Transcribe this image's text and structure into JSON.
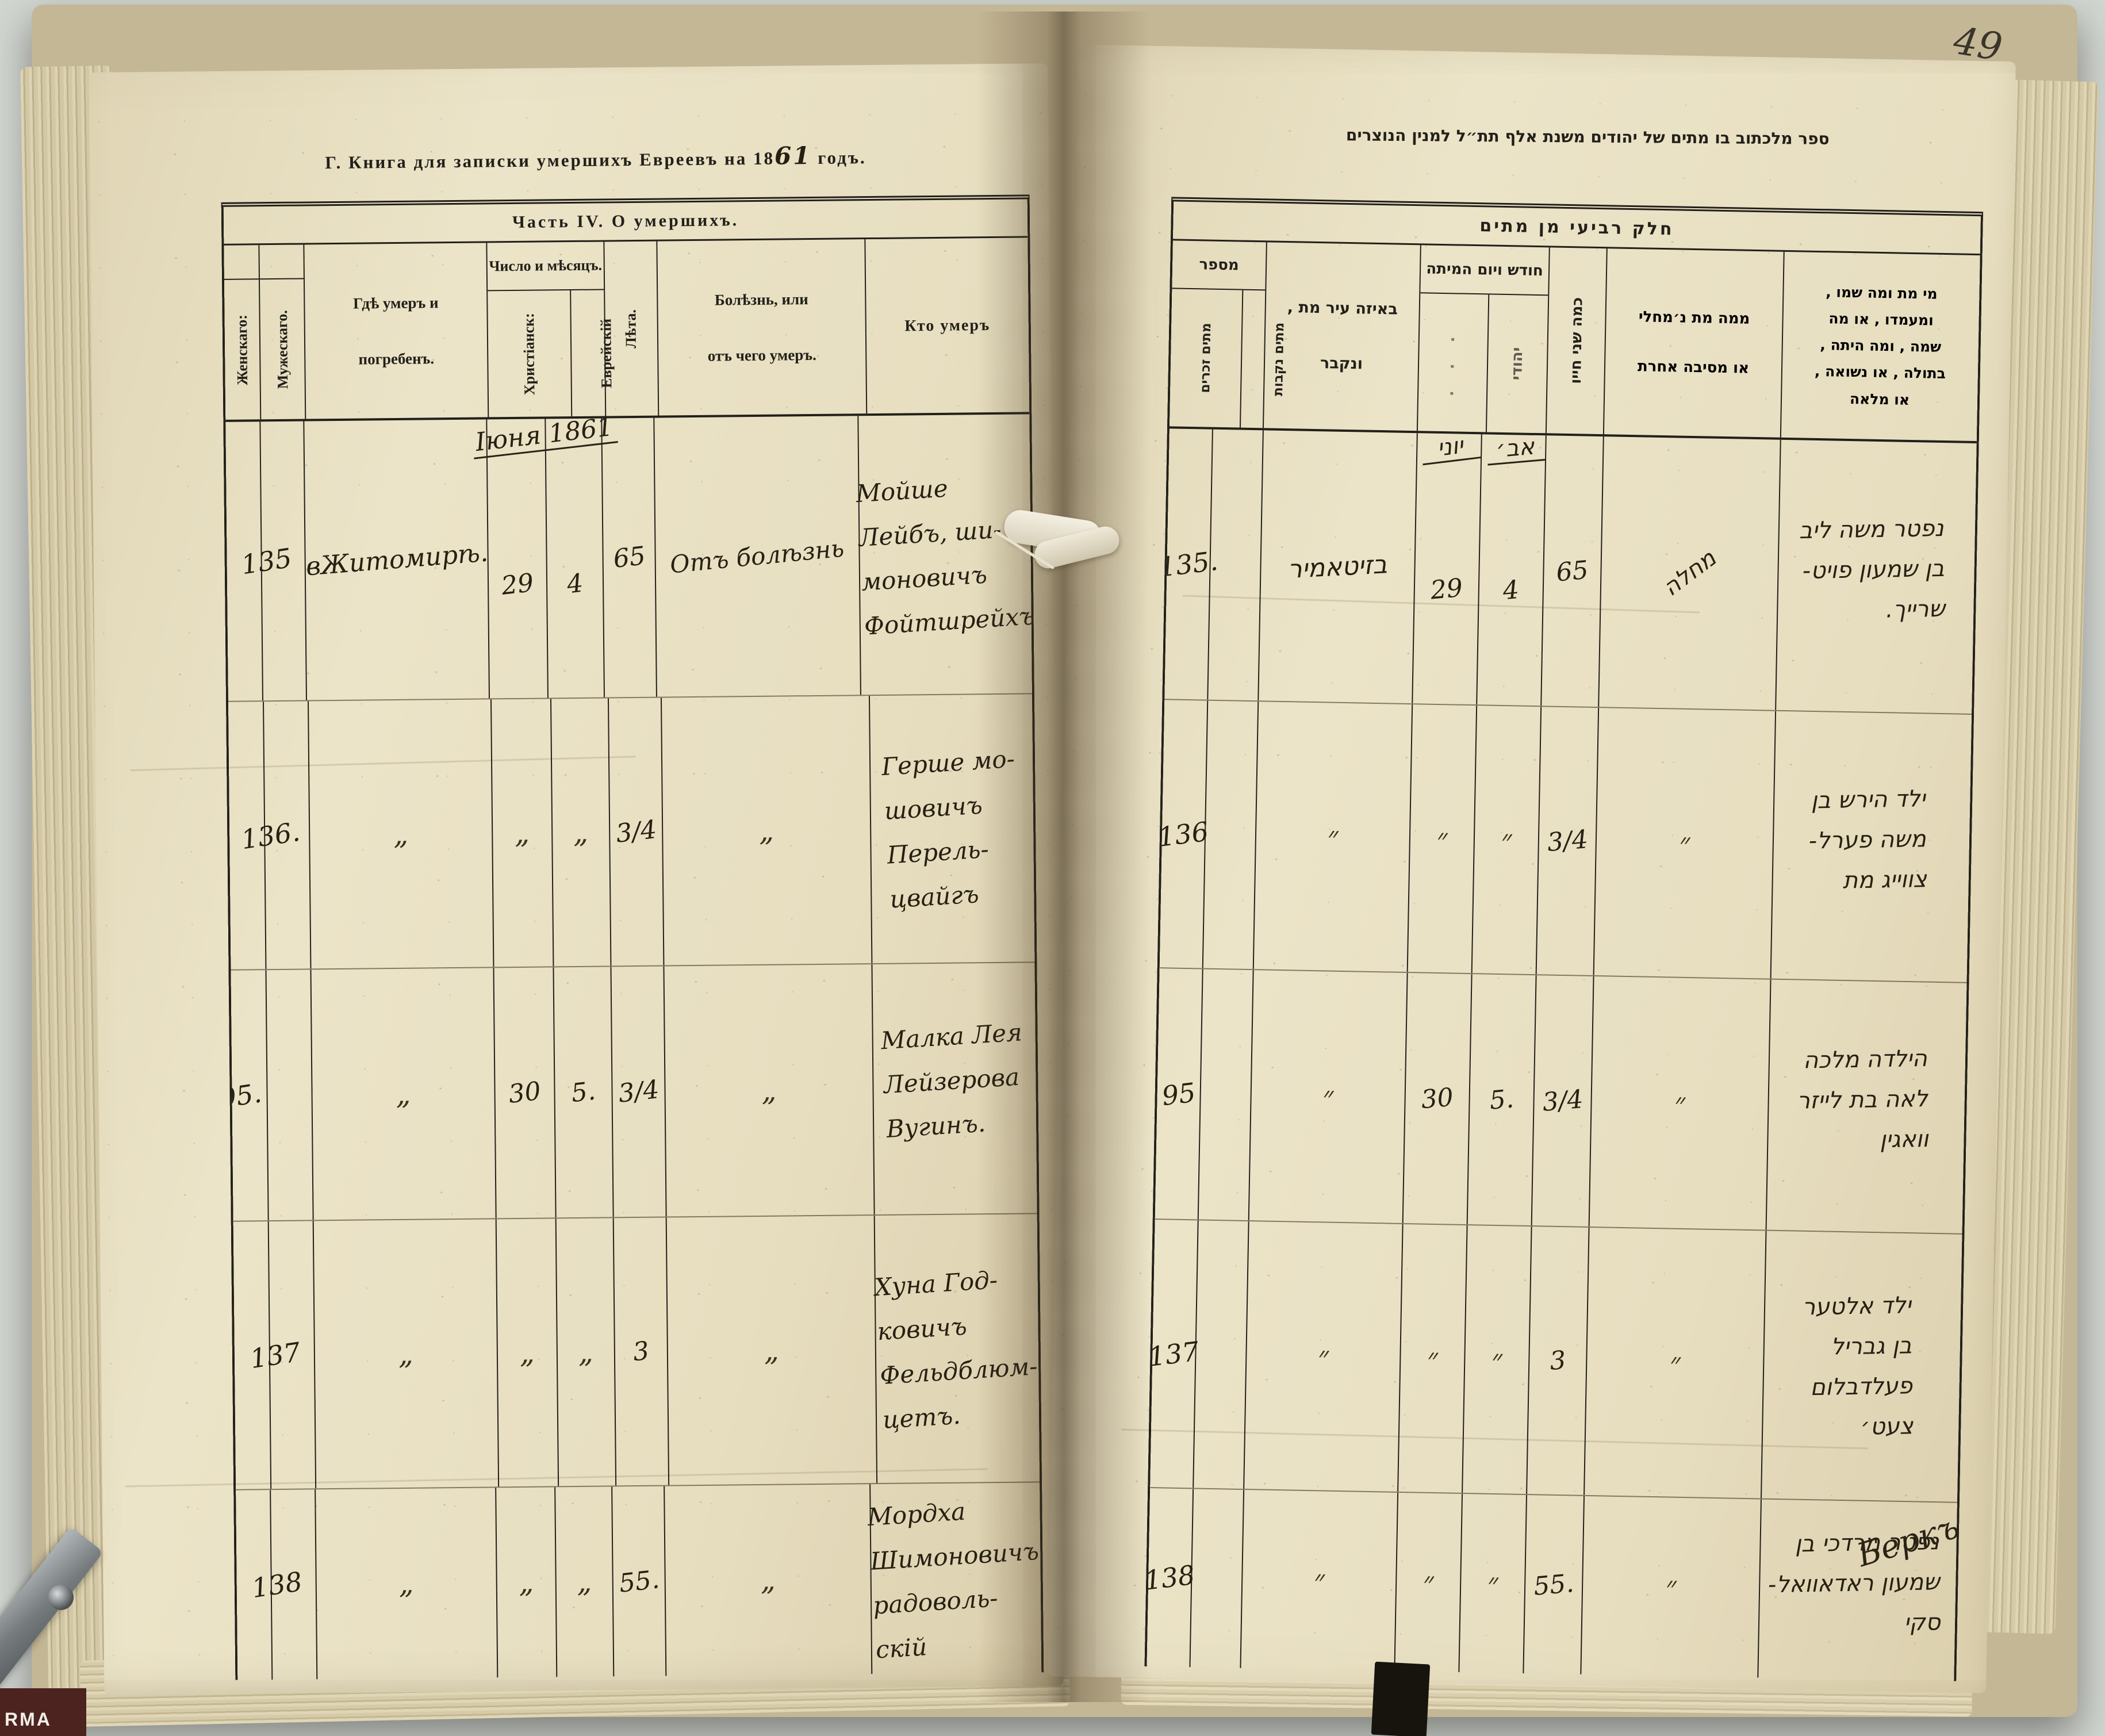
{
  "photo": {
    "background_color": "#d3d7d2",
    "paper_color": "#e8dfc1",
    "ink_color": "#272012"
  },
  "left_page": {
    "title_prefix": "Г. Книга для записки умершихъ Евреевъ на 18",
    "title_year": "61",
    "title_suffix": " годъ.",
    "table_caption": "Часть IV. О умершихъ.",
    "col_female": "Женскаго:",
    "col_male": "Мужескаго.",
    "col_where_lines": [
      "Гдѣ умеръ и",
      "погребенъ."
    ],
    "col_date_group": "Число и мѣсяцъ.",
    "col_date_christian": "Христіанск:",
    "col_date_jewish": "Еврейскій",
    "col_years": "Лѣта.",
    "col_illness_lines": [
      "Болѣзнь, или",
      "отъ чего умеръ."
    ],
    "col_who": "Кто умеръ",
    "month_note": "Іюня 1861",
    "rows": [
      {
        "num": "135",
        "where": "вЖитомирѣ.",
        "date_c": "29",
        "date_j": "4",
        "years": "65",
        "illness": "Отъ болѣзнь",
        "who": [
          "Мойше",
          "Лейбъ, ши-",
          "моновичъ",
          "Фойтшрейхъ"
        ]
      },
      {
        "num": "136.",
        "where": "„",
        "date_c": "„",
        "date_j": "„",
        "years": "3/4",
        "illness": "„",
        "who": [
          "Герше мо-",
          "шовичъ",
          "Перель-",
          "цвайгъ"
        ]
      },
      {
        "num": "95.",
        "where": "„",
        "date_c": "30",
        "date_j": "5.",
        "years": "3/4",
        "illness": "„",
        "who": [
          "Малка Лея",
          "Лейзерова",
          "Вугинъ."
        ]
      },
      {
        "num": "137",
        "where": "„",
        "date_c": "„",
        "date_j": "„",
        "years": "3",
        "illness": "„",
        "who": [
          "Хуна Год-",
          "ковичъ",
          "Фельдблюм-",
          "цетъ."
        ]
      },
      {
        "num": "138",
        "where": "„",
        "date_c": "„",
        "date_j": "„",
        "years": "55.",
        "illness": "„",
        "who": [
          "Мордха",
          "Шимоновичъ",
          "радоволь-",
          "скій"
        ]
      }
    ]
  },
  "right_page": {
    "page_number": "49",
    "title": "ספר מלכתוב בו מתים של יהודים משנת אלף תת״ל למנין הנוצרים",
    "table_caption": "חלק רביעי מן מתים",
    "col_number": "מספר",
    "col_number_sub_left": "מתים זכרים",
    "col_number_sub_right": "מתים נקבות",
    "col_where_lines": [
      "באיזה עיר מת ,",
      "ונקבר"
    ],
    "col_date_group": "חודש ויום המיתה",
    "col_date_sub_left": "· · ·",
    "col_date_sub_right": "יהודי",
    "col_age": "כמה שני חייו",
    "cause_lines": [
      "ממה מת נ׳מחלי",
      "או מסיבה אחרת"
    ],
    "who_lines": [
      "מי מת ומה שמו ,",
      "ומעמדו , או מה",
      "שמה , ומה היתה ,",
      "בתולה , או נשואה ,",
      "או מלאה"
    ],
    "month_note_left": "יוני",
    "month_note_right": "אב׳",
    "rows": [
      {
        "num": "135.",
        "where": "בזיטאמיר",
        "date_c": "29",
        "date_j": "4",
        "age": "65",
        "cause": "מחלה",
        "who": [
          "נפטר משה ליב",
          "בן שמעון פויט-",
          "שרייך."
        ]
      },
      {
        "num": "136",
        "where": "״",
        "date_c": "״",
        "date_j": "״",
        "age": "3/4",
        "cause": "״",
        "who": [
          "ילד הירש בן",
          "משה פערל-",
          "צווייג מת"
        ]
      },
      {
        "num": "95",
        "where": "״",
        "date_c": "30",
        "date_j": "5.",
        "age": "3/4",
        "cause": "״",
        "who": [
          "הילדה מלכה",
          "לאה בת לייזר",
          "וואגין"
        ]
      },
      {
        "num": "137",
        "where": "״",
        "date_c": "״",
        "date_j": "״",
        "age": "3",
        "cause": "״",
        "who": [
          "ילד אלטער",
          "בן גבריל",
          "פעלדבלום",
          "צעט׳"
        ]
      },
      {
        "num": "138",
        "where": "״",
        "date_c": "״",
        "date_j": "״",
        "age": "55.",
        "cause": "״",
        "who": [
          "נפטר מרדכי בן",
          "שמעון ראדאוואל-",
          "סקי"
        ]
      }
    ],
    "signature": "Беркъ"
  },
  "artifacts": {
    "corner_label": "RMA"
  }
}
